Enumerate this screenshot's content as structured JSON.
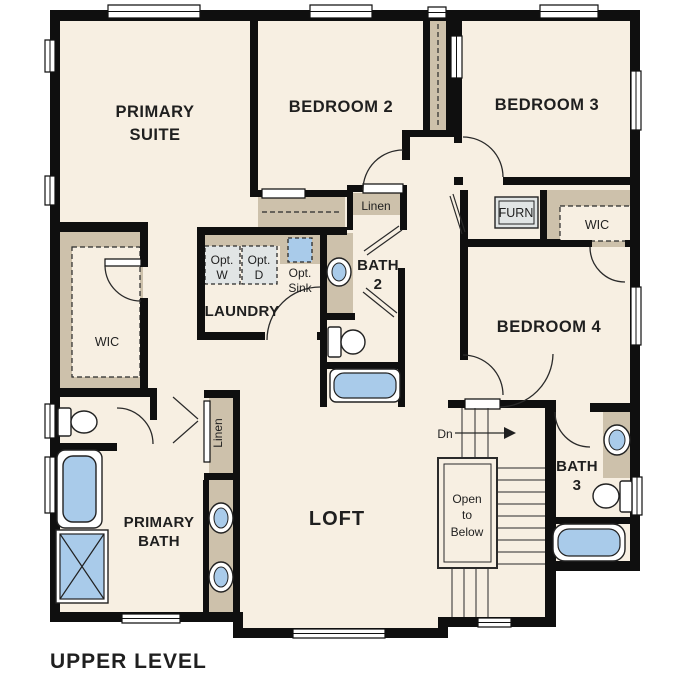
{
  "title": "UPPER LEVEL",
  "colors": {
    "wall": "#0f0f0f",
    "floor": "#f7efe2",
    "closet_tan": "#cdc1ab",
    "fixture_blue": "#a9cbea",
    "appliance_gray": "#e1e5e5",
    "text": "#1f1f1f"
  },
  "rooms": {
    "primary_suite": {
      "line1": "PRIMARY",
      "line2": "SUITE"
    },
    "bedroom2": {
      "label": "BEDROOM 2"
    },
    "bedroom3": {
      "label": "BEDROOM 3"
    },
    "bedroom4": {
      "label": "BEDROOM 4"
    },
    "loft": {
      "label": "LOFT"
    },
    "laundry": {
      "label": "LAUNDRY"
    },
    "primary_bath": {
      "line1": "PRIMARY",
      "line2": "BATH"
    },
    "bath2": {
      "line1": "BATH",
      "line2": "2"
    },
    "bath3": {
      "line1": "BATH",
      "line2": "3"
    },
    "wic_primary": {
      "label": "WIC"
    },
    "wic_bedroom4": {
      "label": "WIC"
    }
  },
  "features": {
    "linen_hall": "Linen",
    "linen_loft": "Linen",
    "furnace": "FURN",
    "opt_washer": {
      "line1": "Opt.",
      "line2": "W"
    },
    "opt_dryer": {
      "line1": "Opt.",
      "line2": "D"
    },
    "opt_sink": {
      "line1": "Opt.",
      "line2": "Sink"
    },
    "stairs": {
      "direction": "Dn",
      "open1": "Open",
      "open2": "to",
      "open3": "Below"
    }
  }
}
